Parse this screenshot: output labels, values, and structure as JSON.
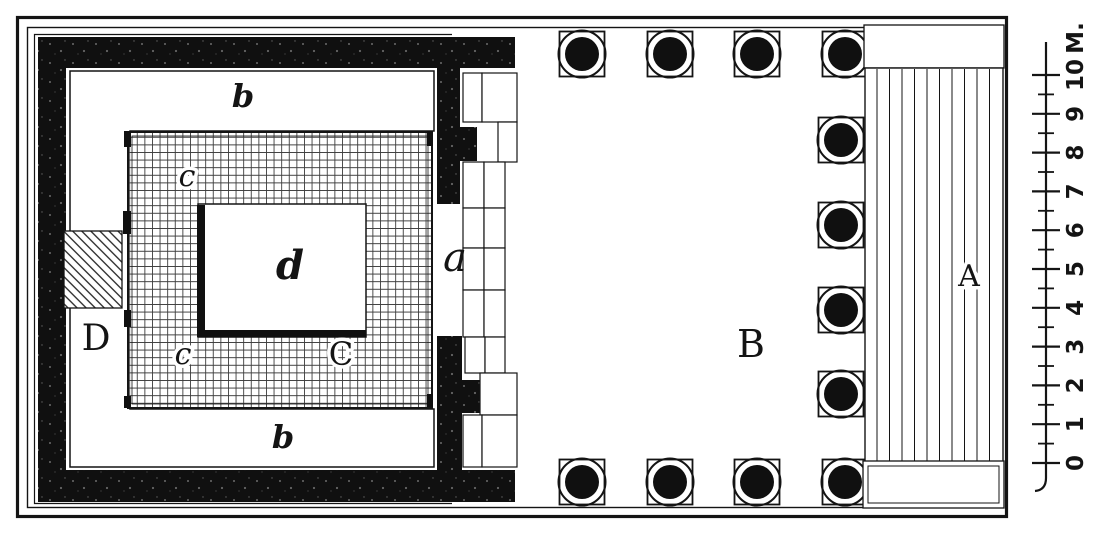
{
  "figure": {
    "kind": "temple floor plan engraving",
    "ink_color": "#141414",
    "paper_color": "#ffffff"
  },
  "labels": {
    "room_b_top": "b",
    "room_b_bottom": "b",
    "pavement_c_upper": "c",
    "pavement_c_lower": "c",
    "pavement_C": "C",
    "base_d": "d",
    "feature_D": "D",
    "door_a": "a",
    "hall_B": "B",
    "stairs_A": "A"
  },
  "scale_bar": {
    "unit": "M.",
    "ticks": [
      "0",
      "1",
      "2",
      "3",
      "4",
      "5",
      "6",
      "7",
      "8",
      "9",
      "10"
    ]
  }
}
